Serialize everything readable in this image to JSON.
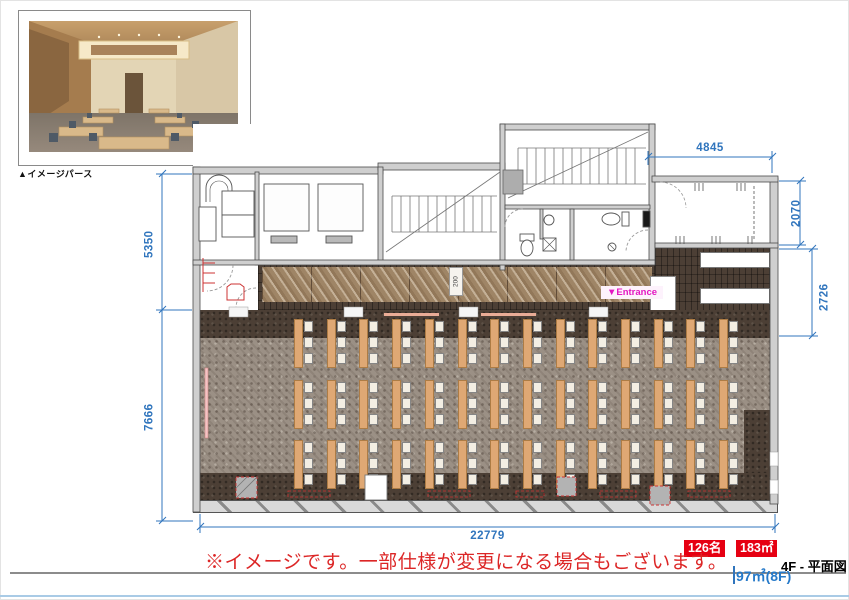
{
  "preview": {
    "caption": "▲イメージパース"
  },
  "plan": {
    "entrance_label": "▼Entrance",
    "corridor_width_label": "200",
    "dimensions": {
      "top_width": "4845",
      "right_upper": "2070",
      "right_lower": "2726",
      "left_upper": "5350",
      "left_lower": "7666",
      "bottom_width": "22779"
    },
    "seating": {
      "rows": 3,
      "columns": 14,
      "chairs_per_table": 3,
      "total_seats": 126,
      "origin_x": 294,
      "origin_y": 319,
      "col_spacing": 32.7,
      "row_spacing": 60.5,
      "chair_offset_x": 10,
      "chair_step_y": 16,
      "chair_first_y": 2
    }
  },
  "footer": {
    "capacity_badge": "126名",
    "area_badge": "183㎡",
    "area_secondary": "97㎡(8F)",
    "sheet_title": "4F - 平面図",
    "disclaimer": "※イメージです。一部仕様が変更になる場合もございます。"
  },
  "colors": {
    "dimension_blue": "#3075bd",
    "badge_red": "#e60012",
    "entrance_magenta": "#e317c2",
    "table_tan": "#dfa874",
    "carpet_gray": "#9b9085",
    "dark_carpet": "#4c3f35",
    "marble_tile": "#9f8566"
  }
}
